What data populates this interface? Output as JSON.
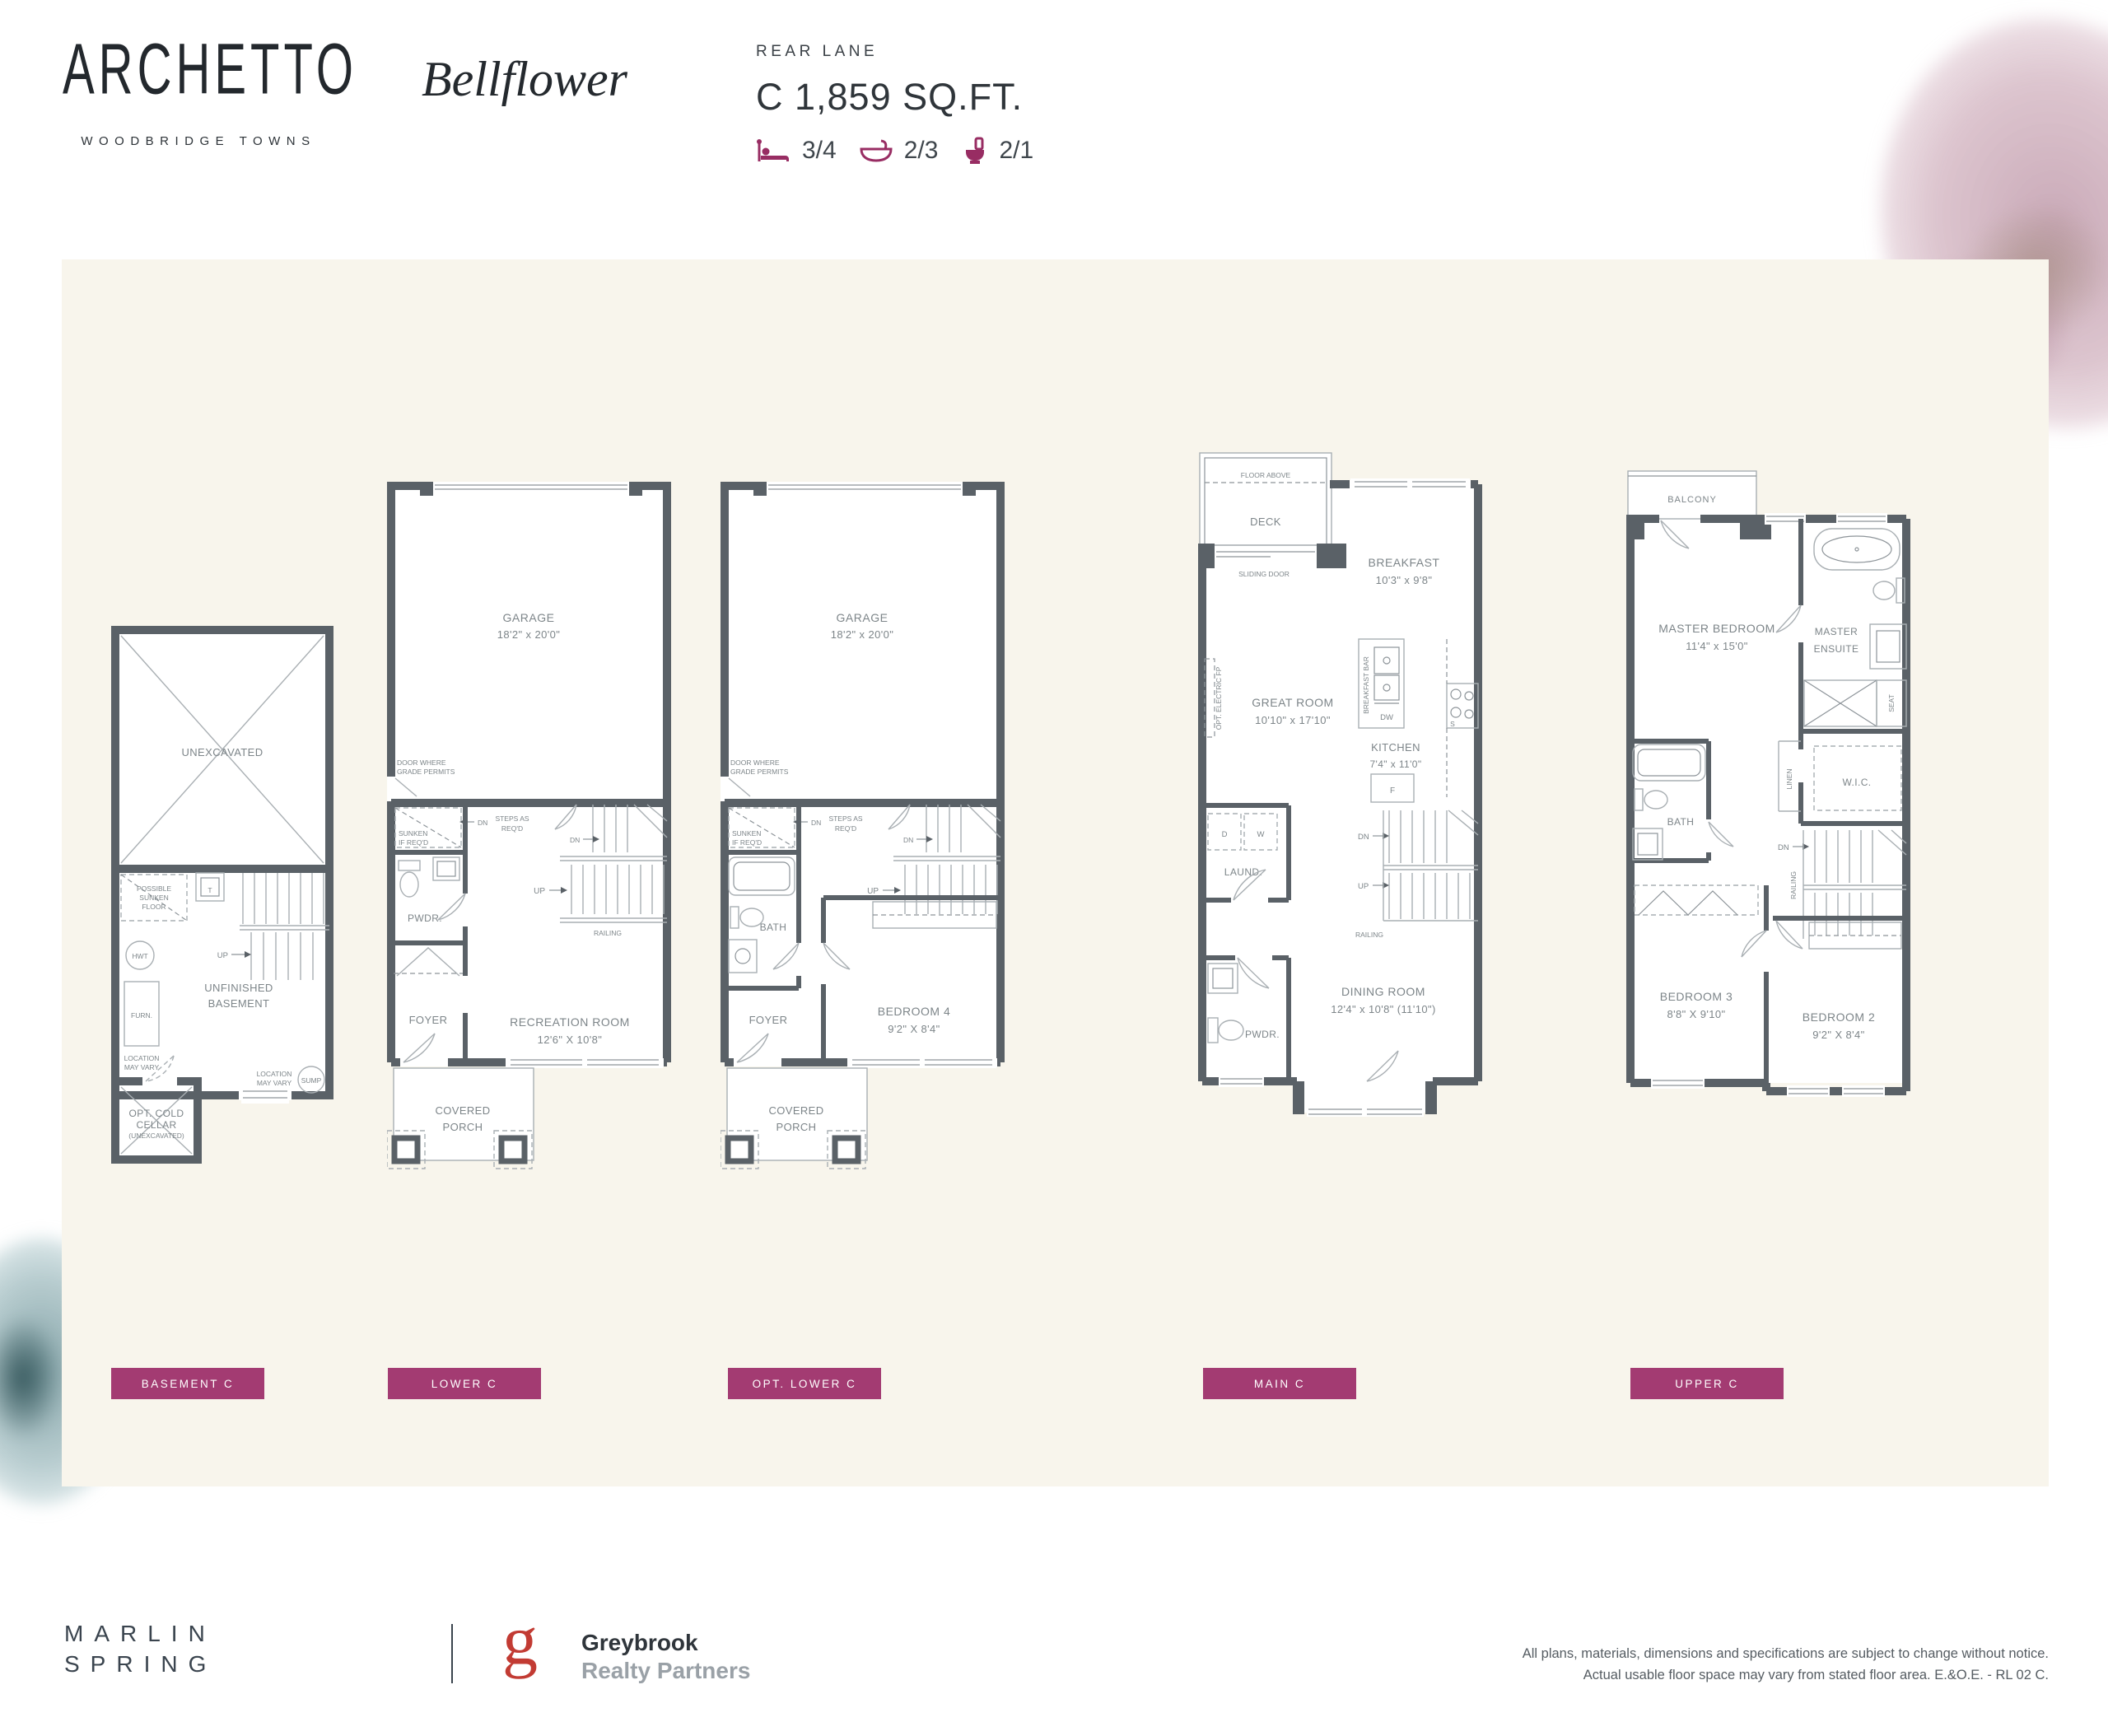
{
  "header": {
    "brand_name": "ARCHETTO",
    "brand_tagline": "WOODBRIDGE TOWNS",
    "model_name": "Bellflower",
    "lane_type": "REAR LANE",
    "plan_size": "C 1,859 SQ.FT.",
    "stats": [
      {
        "icon": "bed-icon",
        "value": "3/4"
      },
      {
        "icon": "bath-icon",
        "value": "2/3"
      },
      {
        "icon": "toilet-icon",
        "value": "2/1"
      }
    ]
  },
  "plans": {
    "basement": {
      "tag": "BASEMENT C",
      "unexcavated": "UNEXCAVATED",
      "sunken": [
        "POSSIBLE",
        "SUNKEN",
        "FLOOR"
      ],
      "t": "T",
      "hwt": "HWT",
      "furn": "FURN.",
      "loc1": [
        "LOCATION",
        "MAY VARY"
      ],
      "up": "UP",
      "room": [
        "UNFINISHED",
        "BASEMENT"
      ],
      "loc2": [
        "LOCATION",
        "MAY VARY"
      ],
      "sump": "SUMP",
      "cellar": [
        "OPT. COLD",
        "CELLAR",
        "(UNEXCAVATED)"
      ]
    },
    "lower": {
      "tag": "LOWER C",
      "garage": [
        "GARAGE",
        "18'2\" x 20'0\""
      ],
      "grade": [
        "DOOR WHERE",
        "GRADE PERMITS"
      ],
      "sunken": [
        "SUNKEN",
        "IF REQ'D"
      ],
      "dn": "DN",
      "steps": [
        "STEPS AS",
        "REQ'D"
      ],
      "up": "UP",
      "railing": "RAILING",
      "pwdr": "PWDR.",
      "rec": [
        "RECREATION ROOM",
        "12'6\" X 10'8\""
      ],
      "foyer": "FOYER",
      "porch": [
        "COVERED",
        "PORCH"
      ]
    },
    "opt": {
      "tag": "OPT. LOWER C",
      "garage": [
        "GARAGE",
        "18'2\" x 20'0\""
      ],
      "grade": [
        "DOOR WHERE",
        "GRADE PERMITS"
      ],
      "sunken": [
        "SUNKEN",
        "IF REQ'D"
      ],
      "dn": "DN",
      "steps": [
        "STEPS AS",
        "REQ'D"
      ],
      "up": "UP",
      "bath": "BATH",
      "bed4": [
        "BEDROOM 4",
        "9'2\" X 8'4\""
      ],
      "foyer": "FOYER",
      "porch": [
        "COVERED",
        "PORCH"
      ]
    },
    "main": {
      "tag": "MAIN C",
      "floor_above": "FLOOR ABOVE",
      "deck": "DECK",
      "sliding": "SLIDING DOOR",
      "breakfast": [
        "BREAKFAST",
        "10'3\" x 9'8\""
      ],
      "great": [
        "GREAT ROOM",
        "10'10\" x 17'10\""
      ],
      "fp": "OPT. ELECTRIC FP",
      "bar": "BREAKFAST BAR",
      "dw": "DW",
      "s": "S",
      "kitchen": [
        "KITCHEN",
        "7'4\" x 11'0\""
      ],
      "f": "F",
      "d": "D",
      "w": "W",
      "laund": "LAUND.",
      "dn": "DN",
      "up": "UP",
      "railing": "RAILING",
      "pwdr": "PWDR.",
      "dining": [
        "DINING ROOM",
        "12'4\" x 10'8\" (11'10\")"
      ]
    },
    "upper": {
      "tag": "UPPER C",
      "balcony": "BALCONY",
      "master": [
        "MASTER BEDROOM",
        "11'4\" x 15'0\""
      ],
      "ensuite": [
        "MASTER",
        "ENSUITE"
      ],
      "seat": "SEAT",
      "wic": "W.I.C.",
      "linen": "LINEN",
      "bath": "BATH",
      "dn": "DN",
      "railing": "RAILING",
      "bed3": [
        "BEDROOM 3",
        "8'8\" X 9'10\""
      ],
      "bed2": [
        "BEDROOM 2",
        "9'2\" X 8'4\""
      ]
    }
  },
  "footer": {
    "marlin": [
      "MARLIN",
      "SPRING"
    ],
    "greybrook_g": "g",
    "greybrook": [
      "Greybrook",
      "Realty Partners"
    ],
    "disclaimer": [
      "All plans, materials, dimensions and specifications are subject to change without notice.",
      "Actual usable floor space may vary from stated floor area. E.&O.E. - RL 02 C."
    ]
  },
  "colors": {
    "accent": "#A33B72",
    "icon": "#982D63",
    "wall": "#5A6167",
    "thin_line": "#A9AFB3",
    "plan_text": "#7D8589",
    "board": "#F8F5EC"
  }
}
